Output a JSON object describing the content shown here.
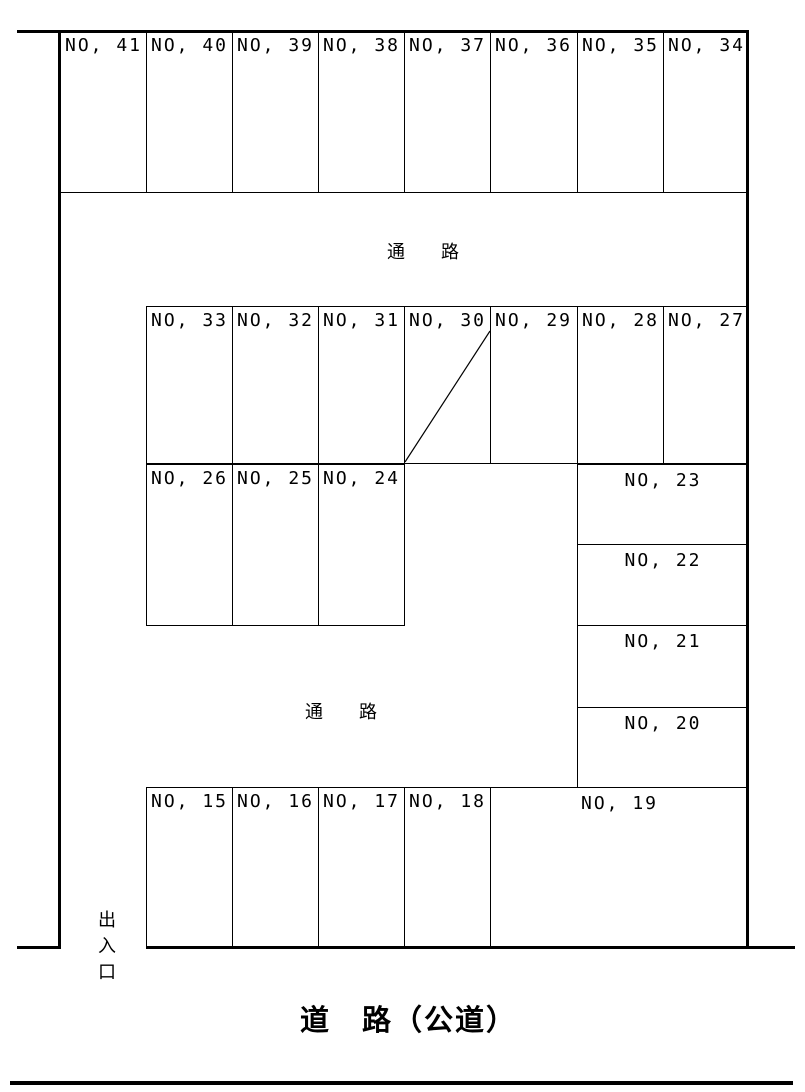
{
  "diagram": {
    "road_label": "道　路（公道）",
    "aisle_top_label": "通　　路",
    "aisle_bottom_label": "通　　路",
    "entrance_label": "出入口"
  },
  "parking": {
    "row_top": [
      "NO, 41",
      "NO, 40",
      "NO, 39",
      "NO, 38",
      "NO, 37",
      "NO, 36",
      "NO, 35",
      "NO, 34"
    ],
    "row_mid": [
      "NO, 33",
      "NO, 32",
      "NO, 31",
      "NO, 30",
      "NO, 29",
      "NO, 28",
      "NO, 27"
    ],
    "row_left": [
      "NO, 26",
      "NO, 25",
      "NO, 24"
    ],
    "stack_right": [
      "NO, 23",
      "NO, 22",
      "NO, 21",
      "NO, 20"
    ],
    "row_bottom": [
      "NO, 15",
      "NO, 16",
      "NO, 17",
      "NO, 18",
      "NO, 19"
    ]
  },
  "colors": {
    "line": "#000000",
    "background": "#ffffff"
  }
}
